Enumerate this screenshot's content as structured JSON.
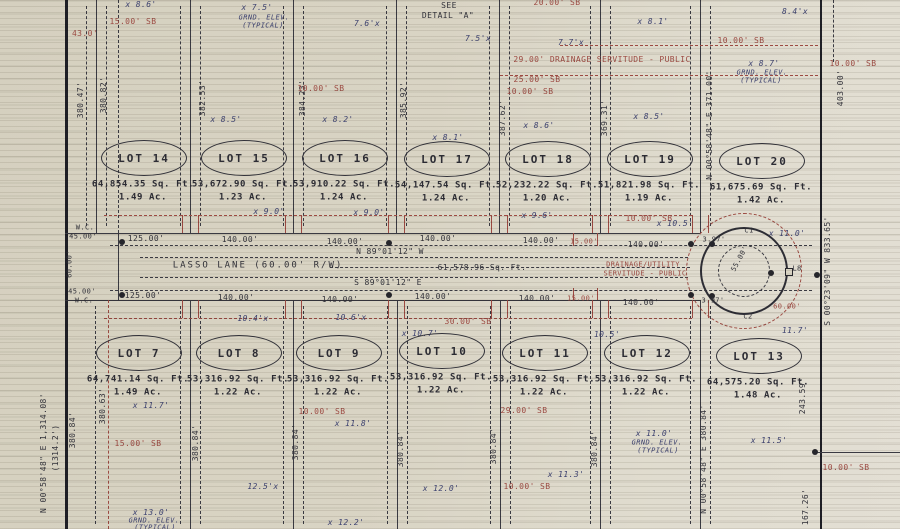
{
  "ink": {
    "black": "#32323a",
    "red": "#9c4a42",
    "blue": "#3d4270",
    "paper": "#d9d4c4"
  },
  "street": {
    "name": "LASSO LANE (60.00' R/W)",
    "bearing_north_side": "N 89°01'12\" W",
    "bearing_south_side": "S 89°01'12\" E",
    "area": "61,578.96 Sq. Ft.",
    "right_of_way_width": "60.00'"
  },
  "lots_top": [
    {
      "label": "LOT 14",
      "area": "64,854.35 Sq. Ft.",
      "acres": "1.49 Ac.",
      "cx": 143,
      "cy": 157
    },
    {
      "label": "LOT 15",
      "area": "53,672.90 Sq. Ft.",
      "acres": "1.23 Ac.",
      "cx": 243,
      "cy": 157
    },
    {
      "label": "LOT 16",
      "area": "53,910.22 Sq. Ft.",
      "acres": "1.24 Ac.",
      "cx": 344,
      "cy": 157
    },
    {
      "label": "LOT 17",
      "area": "54,147.54 Sq. Ft.",
      "acres": "1.24 Ac.",
      "cx": 446,
      "cy": 158
    },
    {
      "label": "LOT 18",
      "area": "52,232.22 Sq. Ft.",
      "acres": "1.20 Ac.",
      "cx": 547,
      "cy": 158
    },
    {
      "label": "LOT 19",
      "area": "51,821.98 Sq. Ft.",
      "acres": "1.19 Ac.",
      "cx": 649,
      "cy": 158
    },
    {
      "label": "LOT 20",
      "area": "61,675.69 Sq. Ft.",
      "acres": "1.42 Ac.",
      "cx": 761,
      "cy": 160
    }
  ],
  "lots_bottom": [
    {
      "label": "LOT 7",
      "area": "64,741.14 Sq. Ft.",
      "acres": "1.49 Ac.",
      "cx": 138,
      "cy": 352
    },
    {
      "label": "LOT 8",
      "area": "53,316.92 Sq. Ft.",
      "acres": "1.22 Ac.",
      "cx": 238,
      "cy": 352
    },
    {
      "label": "LOT 9",
      "area": "53,316.92 Sq. Ft.",
      "acres": "1.22 Ac.",
      "cx": 338,
      "cy": 352
    },
    {
      "label": "LOT 10",
      "area": "53,316.92 Sq. Ft.",
      "acres": "1.22 Ac.",
      "cx": 441,
      "cy": 350
    },
    {
      "label": "LOT 11",
      "area": "53,316.92 Sq. Ft.",
      "acres": "1.22 Ac.",
      "cx": 544,
      "cy": 352
    },
    {
      "label": "LOT 12",
      "area": "53,316.92 Sq. Ft.",
      "acres": "1.22 Ac.",
      "cx": 646,
      "cy": 352
    },
    {
      "label": "LOT 13",
      "area": "64,575.20 Sq. Ft.",
      "acres": "1.48 Ac.",
      "cx": 758,
      "cy": 355
    }
  ],
  "annotations": [
    {
      "t": "SEE",
      "x": 449,
      "y": 6,
      "c": "k",
      "n": "detail-note"
    },
    {
      "t": "DETAIL \"A\"",
      "x": 448,
      "y": 16,
      "c": "k",
      "n": "detail-note"
    },
    {
      "t": "LASSO LANE (60.00' R/W)",
      "x": 258,
      "y": 266,
      "c": "k",
      "fs": 9,
      "ls": 2,
      "n": "street-name"
    },
    {
      "t": "N 89°01'12\" W",
      "x": 390,
      "y": 252,
      "c": "k",
      "n": "street-bearing"
    },
    {
      "t": "61,578.96 Sq. Ft.",
      "x": 482,
      "y": 268,
      "c": "k",
      "n": "street-area"
    },
    {
      "t": "S 89°01'12\" E",
      "x": 388,
      "y": 283,
      "c": "k",
      "n": "street-bearing"
    },
    {
      "t": "125.00'",
      "x": 146,
      "y": 239,
      "c": "k",
      "n": "dimension-label"
    },
    {
      "t": "140.00'",
      "x": 240,
      "y": 240,
      "c": "k",
      "n": "dimension-label"
    },
    {
      "t": "140.00'",
      "x": 345,
      "y": 242,
      "c": "k",
      "n": "dimension-label"
    },
    {
      "t": "140.00'",
      "x": 438,
      "y": 239,
      "c": "k",
      "n": "dimension-label"
    },
    {
      "t": "140.00'",
      "x": 541,
      "y": 241,
      "c": "k",
      "n": "dimension-label"
    },
    {
      "t": "140.00'",
      "x": 646,
      "y": 245,
      "c": "k",
      "n": "dimension-label"
    },
    {
      "t": "125.00'",
      "x": 143,
      "y": 296,
      "c": "k",
      "n": "dimension-label"
    },
    {
      "t": "140.00'",
      "x": 236,
      "y": 298,
      "c": "k",
      "n": "dimension-label"
    },
    {
      "t": "140.00'",
      "x": 340,
      "y": 300,
      "c": "k",
      "n": "dimension-label"
    },
    {
      "t": "140.00'",
      "x": 433,
      "y": 297,
      "c": "k",
      "n": "dimension-label"
    },
    {
      "t": "140.00'",
      "x": 537,
      "y": 299,
      "c": "k",
      "n": "dimension-label"
    },
    {
      "t": "140.00'",
      "x": 641,
      "y": 303,
      "c": "k",
      "n": "dimension-label"
    },
    {
      "t": "15.00'",
      "x": 584,
      "y": 242,
      "c": "r",
      "fs": 7,
      "n": "dimension-label"
    },
    {
      "t": "15.00'",
      "x": 581,
      "y": 299,
      "c": "r",
      "fs": 7,
      "n": "dimension-label"
    },
    {
      "t": "W.C.",
      "x": 85,
      "y": 228,
      "c": "k",
      "fs": 7,
      "n": "witness-corner-label"
    },
    {
      "t": "45.00'",
      "x": 83,
      "y": 237,
      "c": "k",
      "fs": 7,
      "n": "dimension-label"
    },
    {
      "t": "45.00'",
      "x": 82,
      "y": 292,
      "c": "k",
      "fs": 7,
      "n": "dimension-label"
    },
    {
      "t": "W.C.",
      "x": 84,
      "y": 301,
      "c": "k",
      "fs": 7,
      "n": "witness-corner-label"
    },
    {
      "t": "60.00'",
      "x": 70,
      "y": 264,
      "c": "k",
      "r": -90,
      "fs": 7,
      "n": "dimension-label"
    },
    {
      "t": "3.97'",
      "x": 714,
      "y": 240,
      "c": "k",
      "fs": 7,
      "n": "dimension-label"
    },
    {
      "t": "3.97'",
      "x": 713,
      "y": 301,
      "c": "k",
      "fs": 7,
      "n": "dimension-label"
    },
    {
      "t": "C1",
      "x": 749,
      "y": 231,
      "c": "k",
      "fs": 7,
      "n": "curve-label"
    },
    {
      "t": "C2",
      "x": 748,
      "y": 317,
      "c": "k",
      "fs": 7,
      "n": "curve-label"
    },
    {
      "t": "L8",
      "x": 797,
      "y": 269,
      "c": "k",
      "fs": 7,
      "n": "curve-label"
    },
    {
      "t": "55.00'",
      "x": 740,
      "y": 259,
      "c": "k",
      "r": -62,
      "fs": 7,
      "n": "radius-label"
    },
    {
      "t": "N 00°58'48\" E  1,314.08'",
      "x": 44,
      "y": 453,
      "c": "k",
      "r": -90,
      "n": "boundary-bearing"
    },
    {
      "t": "(1314.2')",
      "x": 56,
      "y": 448,
      "c": "k",
      "r": -90,
      "n": "boundary-bearing"
    },
    {
      "t": "S 00°23'09\" W  833.65'",
      "x": 828,
      "y": 271,
      "c": "k",
      "r": -90,
      "n": "boundary-bearing"
    },
    {
      "t": "380.47'",
      "x": 81,
      "y": 100,
      "c": "k",
      "r": -90,
      "n": "lot-depth-label"
    },
    {
      "t": "380.82'",
      "x": 104,
      "y": 95,
      "c": "k",
      "r": -90,
      "n": "lot-depth-label"
    },
    {
      "t": "382.53'",
      "x": 203,
      "y": 98,
      "c": "k",
      "r": -90,
      "n": "lot-depth-label"
    },
    {
      "t": "384.23'",
      "x": 303,
      "y": 98,
      "c": "k",
      "r": -90,
      "n": "lot-depth-label"
    },
    {
      "t": "385.92'",
      "x": 404,
      "y": 100,
      "c": "k",
      "r": -90,
      "n": "lot-depth-label"
    },
    {
      "t": "387.62'",
      "x": 503,
      "y": 118,
      "c": "k",
      "r": -90,
      "n": "lot-depth-label"
    },
    {
      "t": "369.31'",
      "x": 605,
      "y": 118,
      "c": "k",
      "r": -90,
      "n": "lot-depth-label"
    },
    {
      "t": "N 00°58'48\" E  371.00'",
      "x": 710,
      "y": 125,
      "c": "k",
      "r": -90,
      "n": "lot-depth-label"
    },
    {
      "t": "403.00'",
      "x": 841,
      "y": 88,
      "c": "k",
      "r": -90,
      "n": "lot-depth-label"
    },
    {
      "t": "380.63'",
      "x": 103,
      "y": 406,
      "c": "k",
      "r": -90,
      "n": "lot-depth-label"
    },
    {
      "t": "380.84'",
      "x": 73,
      "y": 430,
      "c": "k",
      "r": -90,
      "n": "lot-depth-label"
    },
    {
      "t": "380.84'",
      "x": 196,
      "y": 443,
      "c": "k",
      "r": -90,
      "n": "lot-depth-label"
    },
    {
      "t": "380.84'",
      "x": 296,
      "y": 442,
      "c": "k",
      "r": -90,
      "n": "lot-depth-label"
    },
    {
      "t": "380.84'",
      "x": 401,
      "y": 449,
      "c": "k",
      "r": -90,
      "n": "lot-depth-label"
    },
    {
      "t": "380.84'",
      "x": 494,
      "y": 446,
      "c": "k",
      "r": -90,
      "n": "lot-depth-label"
    },
    {
      "t": "380.84'",
      "x": 595,
      "y": 449,
      "c": "k",
      "r": -90,
      "n": "lot-depth-label"
    },
    {
      "t": "N 00°58'48\" E  380.84'",
      "x": 704,
      "y": 459,
      "c": "k",
      "r": -90,
      "n": "lot-depth-label"
    },
    {
      "t": "243.59'",
      "x": 803,
      "y": 396,
      "c": "k",
      "r": -90,
      "n": "lot-depth-label"
    },
    {
      "t": "167.26'",
      "x": 806,
      "y": 507,
      "c": "k",
      "r": -90,
      "n": "lot-depth-label"
    },
    {
      "t": "15.00' SB",
      "x": 133,
      "y": 22,
      "c": "r",
      "n": "setback-label"
    },
    {
      "t": "43.0'",
      "x": 85,
      "y": 34,
      "c": "r",
      "n": "dimension-label"
    },
    {
      "t": "10.00' SB",
      "x": 321,
      "y": 89,
      "c": "r",
      "n": "setback-label"
    },
    {
      "t": "20.00' SB",
      "x": 557,
      "y": 3,
      "c": "r",
      "n": "setback-label"
    },
    {
      "t": "29.00' DRAINAGE SERVITUDE - PUBLIC",
      "x": 602,
      "y": 60,
      "c": "r",
      "n": "servitude-label"
    },
    {
      "t": "25.00' SB",
      "x": 537,
      "y": 80,
      "c": "r",
      "n": "setback-label"
    },
    {
      "t": "10.00' SB",
      "x": 530,
      "y": 92,
      "c": "r",
      "n": "setback-label"
    },
    {
      "t": "10.00' SB",
      "x": 741,
      "y": 41,
      "c": "r",
      "n": "setback-label"
    },
    {
      "t": "10.00' SB",
      "x": 853,
      "y": 64,
      "c": "r",
      "n": "setback-label"
    },
    {
      "t": "10.00' SB",
      "x": 649,
      "y": 219,
      "c": "r",
      "n": "setback-label"
    },
    {
      "t": "30.00' SB",
      "x": 468,
      "y": 322,
      "c": "r",
      "n": "setback-label"
    },
    {
      "t": "29.00' SB",
      "x": 524,
      "y": 411,
      "c": "r",
      "n": "setback-label"
    },
    {
      "t": "10.00' SB",
      "x": 322,
      "y": 412,
      "c": "r",
      "n": "setback-label"
    },
    {
      "t": "15.00' SB",
      "x": 138,
      "y": 444,
      "c": "r",
      "n": "setback-label"
    },
    {
      "t": "10.00' SB",
      "x": 527,
      "y": 487,
      "c": "r",
      "n": "setback-label"
    },
    {
      "t": "10.00' SB",
      "x": 846,
      "y": 468,
      "c": "r",
      "n": "setback-label"
    },
    {
      "t": "60.00'",
      "x": 787,
      "y": 307,
      "c": "r",
      "fs": 7,
      "n": "dimension-label"
    },
    {
      "t": "DRAINAGE/UTILITY",
      "x": 643,
      "y": 265,
      "c": "r",
      "fs": 7,
      "n": "servitude-label"
    },
    {
      "t": "SERVITUDE - PUBLIC",
      "x": 645,
      "y": 274,
      "c": "r",
      "fs": 7,
      "n": "servitude-label"
    },
    {
      "t": "x 8.6'",
      "x": 141,
      "y": 5,
      "c": "b",
      "n": "ground-elevation-label"
    },
    {
      "t": "x 7.5'",
      "x": 257,
      "y": 8,
      "c": "b",
      "n": "ground-elevation-label"
    },
    {
      "t": "GRND. ELEV.",
      "x": 264,
      "y": 18,
      "c": "b",
      "fs": 7,
      "n": "ground-elevation-label"
    },
    {
      "t": "(TYPICAL)",
      "x": 263,
      "y": 26,
      "c": "b",
      "fs": 7,
      "n": "ground-elevation-label"
    },
    {
      "t": "7.6'x",
      "x": 367,
      "y": 24,
      "c": "b",
      "n": "ground-elevation-label"
    },
    {
      "t": "7.5'x",
      "x": 478,
      "y": 39,
      "c": "b",
      "n": "ground-elevation-label"
    },
    {
      "t": "7.7'x",
      "x": 571,
      "y": 43,
      "c": "b",
      "n": "ground-elevation-label"
    },
    {
      "t": "x 8.1'",
      "x": 653,
      "y": 22,
      "c": "b",
      "n": "ground-elevation-label"
    },
    {
      "t": "8.4'x",
      "x": 795,
      "y": 12,
      "c": "b",
      "n": "ground-elevation-label"
    },
    {
      "t": "x 8.7'",
      "x": 764,
      "y": 64,
      "c": "b",
      "n": "ground-elevation-label"
    },
    {
      "t": "GRND. ELEV.",
      "x": 762,
      "y": 73,
      "c": "b",
      "fs": 7,
      "n": "ground-elevation-label"
    },
    {
      "t": "(TYPICAL)",
      "x": 761,
      "y": 81,
      "c": "b",
      "fs": 7,
      "n": "ground-elevation-label"
    },
    {
      "t": "x 8.5'",
      "x": 226,
      "y": 120,
      "c": "b",
      "n": "ground-elevation-label"
    },
    {
      "t": "x 8.2'",
      "x": 338,
      "y": 120,
      "c": "b",
      "n": "ground-elevation-label"
    },
    {
      "t": "x 8.1'",
      "x": 448,
      "y": 138,
      "c": "b",
      "n": "ground-elevation-label"
    },
    {
      "t": "x 8.6'",
      "x": 539,
      "y": 126,
      "c": "b",
      "n": "ground-elevation-label"
    },
    {
      "t": "x 8.5'",
      "x": 649,
      "y": 117,
      "c": "b",
      "n": "ground-elevation-label"
    },
    {
      "t": "x 9.0'",
      "x": 269,
      "y": 212,
      "c": "b",
      "n": "ground-elevation-label"
    },
    {
      "t": "x 9.0'",
      "x": 369,
      "y": 213,
      "c": "b",
      "n": "ground-elevation-label"
    },
    {
      "t": "x 9.6'",
      "x": 537,
      "y": 216,
      "c": "b",
      "n": "ground-elevation-label"
    },
    {
      "t": "x 10.5'",
      "x": 675,
      "y": 224,
      "c": "b",
      "n": "ground-elevation-label"
    },
    {
      "t": "x 11.0'",
      "x": 787,
      "y": 234,
      "c": "b",
      "n": "ground-elevation-label"
    },
    {
      "t": "10.4'x",
      "x": 253,
      "y": 319,
      "c": "b",
      "n": "ground-elevation-label"
    },
    {
      "t": "10.6'x",
      "x": 351,
      "y": 318,
      "c": "b",
      "n": "ground-elevation-label"
    },
    {
      "t": "x 10.7'",
      "x": 420,
      "y": 334,
      "c": "b",
      "n": "ground-elevation-label"
    },
    {
      "t": "10.5'",
      "x": 607,
      "y": 335,
      "c": "b",
      "n": "ground-elevation-label"
    },
    {
      "t": "11.7'",
      "x": 795,
      "y": 331,
      "c": "b",
      "n": "ground-elevation-label"
    },
    {
      "t": "x 11.7'",
      "x": 151,
      "y": 406,
      "c": "b",
      "n": "ground-elevation-label"
    },
    {
      "t": "12.5'x",
      "x": 263,
      "y": 487,
      "c": "b",
      "n": "ground-elevation-label"
    },
    {
      "t": "x 13.0'",
      "x": 151,
      "y": 513,
      "c": "b",
      "n": "ground-elevation-label"
    },
    {
      "t": "GRND. ELEV.",
      "x": 154,
      "y": 521,
      "c": "b",
      "fs": 7,
      "n": "ground-elevation-label"
    },
    {
      "t": "(TYPICAL)",
      "x": 155,
      "y": 528,
      "c": "b",
      "fs": 7,
      "n": "ground-elevation-label"
    },
    {
      "t": "x 11.8'",
      "x": 353,
      "y": 424,
      "c": "b",
      "n": "ground-elevation-label"
    },
    {
      "t": "x 12.0'",
      "x": 441,
      "y": 489,
      "c": "b",
      "n": "ground-elevation-label"
    },
    {
      "t": "x 11.3'",
      "x": 566,
      "y": 475,
      "c": "b",
      "n": "ground-elevation-label"
    },
    {
      "t": "x 11.0'",
      "x": 654,
      "y": 434,
      "c": "b",
      "n": "ground-elevation-label"
    },
    {
      "t": "GRND. ELEV.",
      "x": 657,
      "y": 443,
      "c": "b",
      "fs": 7,
      "n": "ground-elevation-label"
    },
    {
      "t": "(TYPICAL)",
      "x": 658,
      "y": 451,
      "c": "b",
      "fs": 7,
      "n": "ground-elevation-label"
    },
    {
      "t": "x 11.5'",
      "x": 769,
      "y": 441,
      "c": "b",
      "n": "ground-elevation-label"
    },
    {
      "t": "x 12.2'",
      "x": 346,
      "y": 523,
      "c": "b",
      "n": "ground-elevation-label"
    }
  ]
}
